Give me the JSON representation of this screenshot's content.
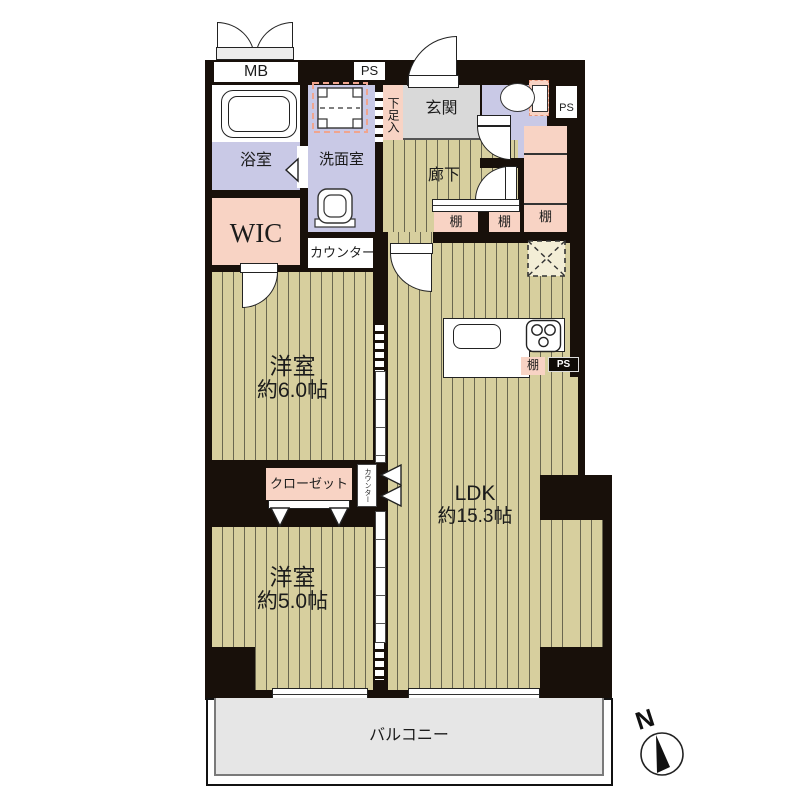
{
  "plan": {
    "labels": {
      "mb": "MB",
      "ps": "PS",
      "bath": "浴室",
      "washroom": "洗面室",
      "shoe_cabinet": "下足入",
      "entrance": "玄関",
      "corridor": "廊下",
      "shelf": "棚",
      "wic": "WIC",
      "counter": "カウンター",
      "closet": "クローゼット",
      "balcony": "バルコニー",
      "compass_north": "N"
    },
    "rooms": {
      "bedroom1": {
        "name": "洋室",
        "size": "約6.0帖"
      },
      "bedroom2": {
        "name": "洋室",
        "size": "約5.0帖"
      },
      "ldk": {
        "name": "LDK",
        "size": "約15.3帖"
      }
    },
    "colors": {
      "wall": "#18100a",
      "wood_floor": "#d7cf9e",
      "wood_stripe": "#6a6750",
      "wet_area": "#c9c9e6",
      "storage_pink": "#f8d3c4",
      "entrance_gray": "#d9d9d9",
      "balcony_gray": "#e6e6e6"
    }
  }
}
